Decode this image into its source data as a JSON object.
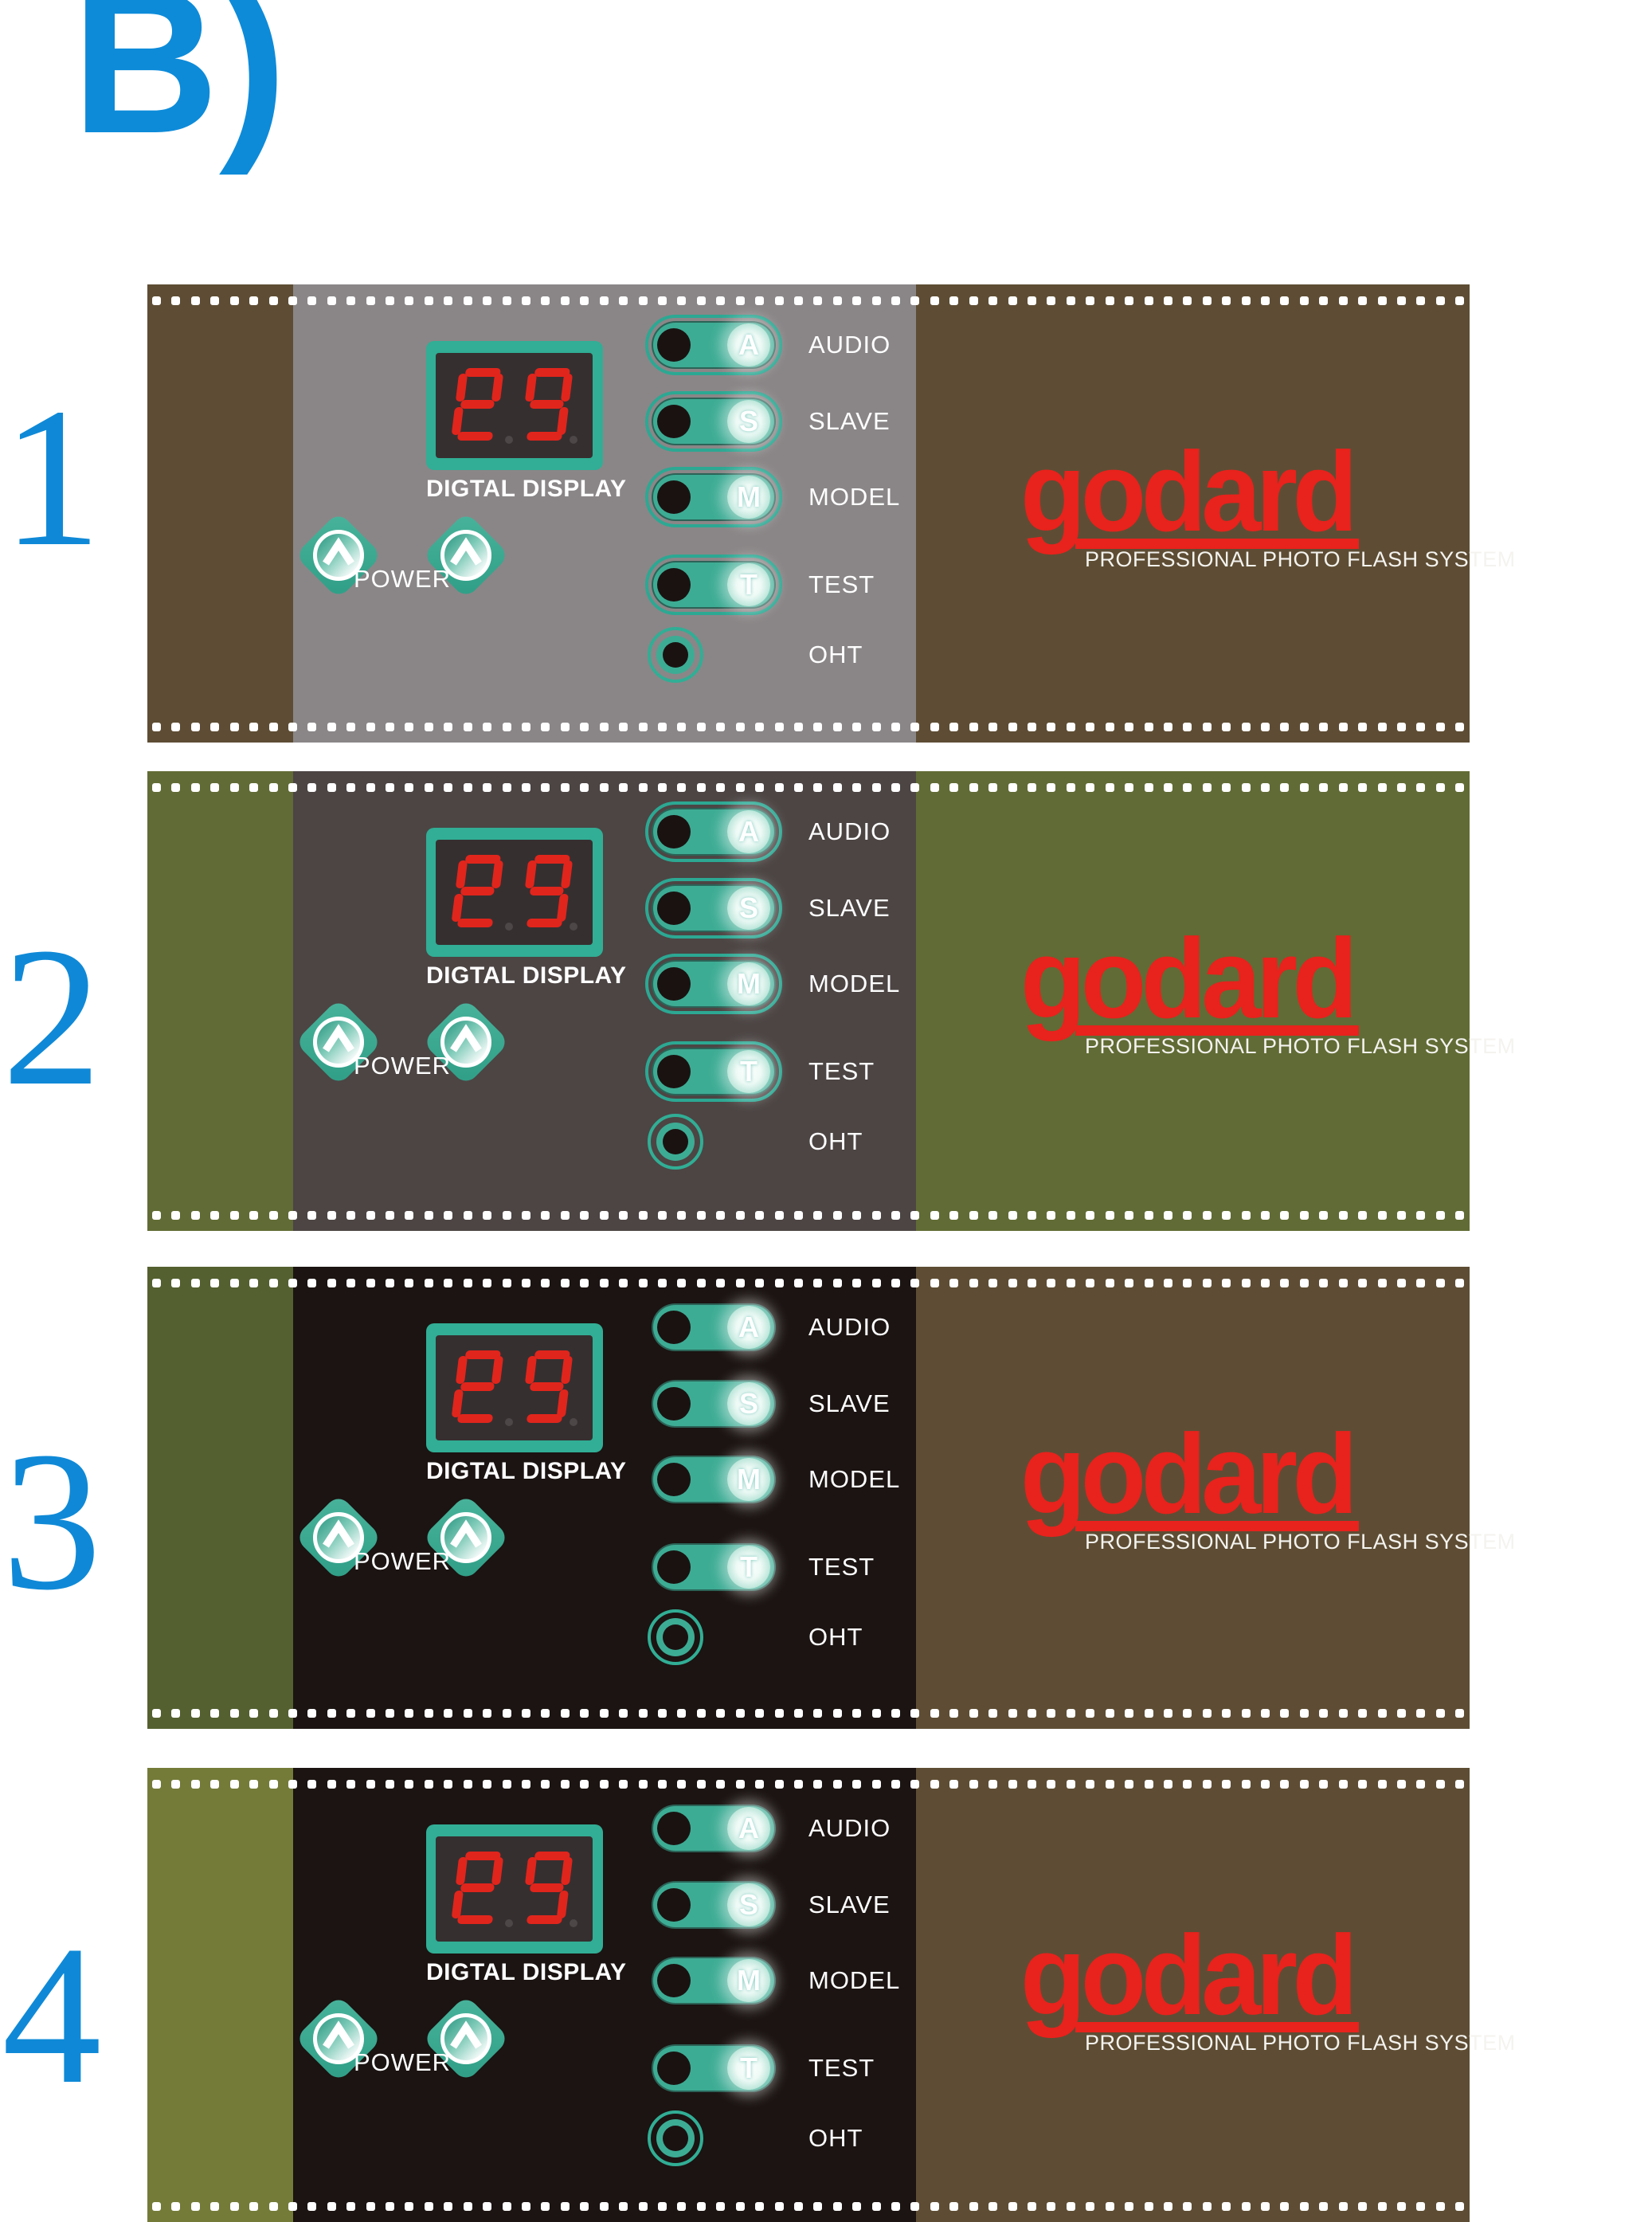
{
  "page_label": "B)",
  "brand": {
    "name": "godard",
    "tagline": "PROFESSIONAL PHOTO FLASH SYSTEM"
  },
  "controls": {
    "display_label": "DIGTAL DISPLAY",
    "digital_display": {
      "reading": "88",
      "digits": [
        {
          "segments": [
            "a",
            "b",
            "d",
            "e",
            "f",
            "g"
          ]
        },
        {
          "segments": [
            "a",
            "b",
            "c",
            "d",
            "f",
            "g"
          ]
        }
      ]
    },
    "power_label": "POWER",
    "switches": [
      {
        "key": "A",
        "label": "AUDIO"
      },
      {
        "key": "S",
        "label": "SLAVE"
      },
      {
        "key": "M",
        "label": "MODEL"
      },
      {
        "key": "T",
        "label": "TEST"
      }
    ],
    "indicator_label": "OHT"
  },
  "panels": [
    {
      "number": "1",
      "colors": {
        "left": "#5e4d34",
        "face": "#8a8687",
        "right": "#5e4d34",
        "switch_ring": "#2ca893"
      }
    },
    {
      "number": "2",
      "colors": {
        "left": "#616b35",
        "face": "#4c4544",
        "right": "#616b35",
        "switch_ring": "#2ca893"
      }
    },
    {
      "number": "3",
      "colors": {
        "left": "#546030",
        "face": "#1b1412",
        "right": "#5e4d34",
        "switch_ring": "transparent"
      }
    },
    {
      "number": "4",
      "colors": {
        "left": "#747b39",
        "face": "#1b1412",
        "right": "#5e4d34",
        "switch_ring": "transparent"
      }
    }
  ],
  "colors": {
    "accent_teal": "#31ae95",
    "pill_teal": "#3dac94",
    "digit_red": "#e0251c",
    "display_bg": "#362f30",
    "display_dot": "#4d4748",
    "brand_red": "#e8221c",
    "knob_black": "#1a1211",
    "perforation_white": "#ffffff",
    "number_blue": "#0f89d7",
    "heading_blue": "#0d8bd9"
  }
}
